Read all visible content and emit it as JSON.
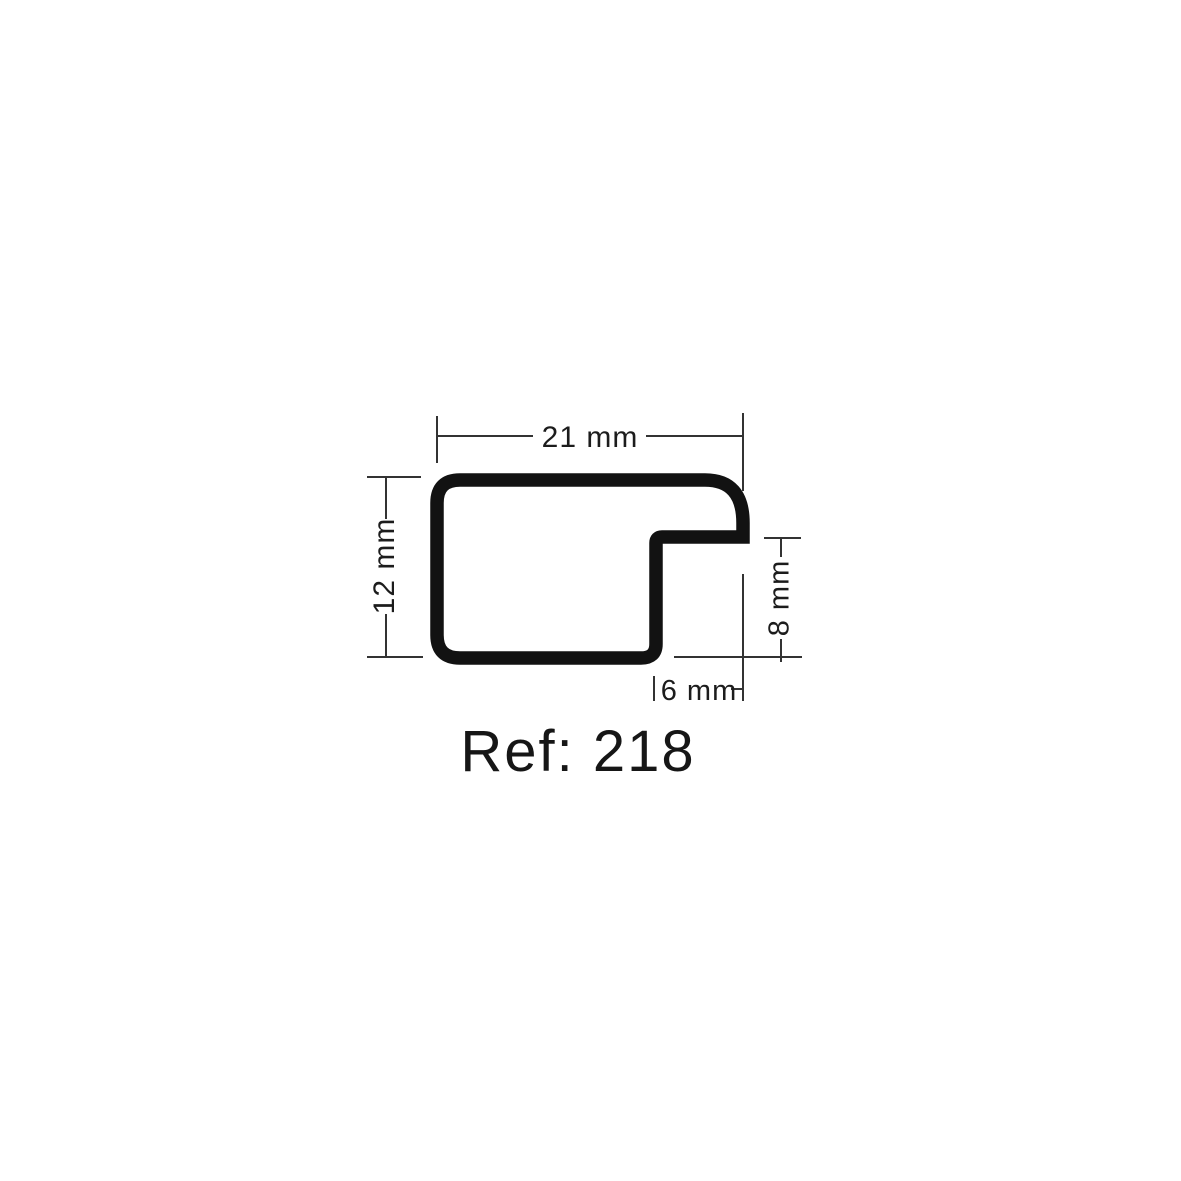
{
  "diagram": {
    "ref_label": "Ref: 218",
    "dimensions": {
      "overall_width": "21 mm",
      "overall_height": "12 mm",
      "rabbet_height": "8 mm",
      "rabbet_width": "6 mm"
    },
    "colors": {
      "profile_stroke": "#121212",
      "dimension_line": "#333333",
      "label_text": "#1c1c1c",
      "background": "#ffffff"
    }
  }
}
